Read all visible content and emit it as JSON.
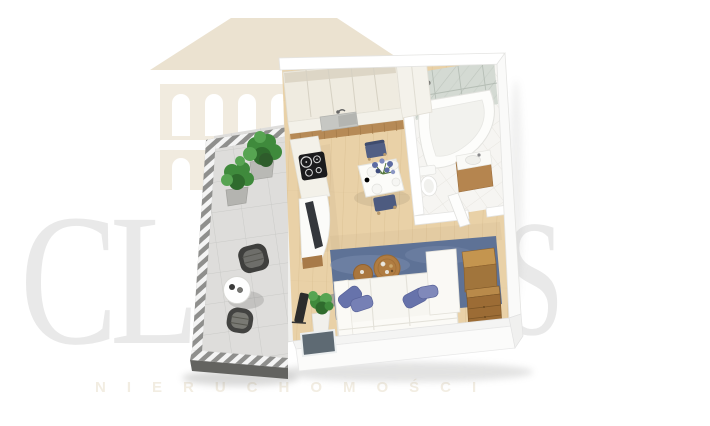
{
  "watermark": {
    "brand_letters_left": "CL",
    "brand_letter_right": "S",
    "tagline": "NIERUCHOMOŚCI"
  },
  "palette": {
    "wm_letter": "#e9e9e9",
    "wm_logo": "#f1ebdf",
    "wm_logo_roof": "#ebe2d0",
    "wm_tagline": "#f2ede2",
    "wall": "#ffffff",
    "wall_edge": "#e4e4e2",
    "wood_floor": "#e9d1a7",
    "wood_line": "#d9bd90",
    "balcony_tile": "#dedddb",
    "railing": "#8f8f8d",
    "railing_dark": "#636360",
    "cabinet": "#efebe0",
    "counter": "#f3f1e9",
    "marble": "#d4dad3",
    "island_wood": "#b68a56",
    "cooktop": "#1b1b1d",
    "steel": "#c6c7c3",
    "rug": "#5e7296",
    "rug_light": "#7e90b2",
    "pillow": "#6773ab",
    "sofa": "#f7f6f1",
    "coffee_wood": "#b07c41",
    "chest_top": "#c4954f",
    "chest_front": "#9c6c35",
    "plant": "#3f8a3c",
    "plant_dark": "#2f6b2d",
    "chair_blue": "#515f84",
    "dark_item": "#34373c"
  },
  "scene": {
    "type": "3d-floorplan-top-view",
    "rooms": [
      "balcony",
      "kitchen",
      "dining-area",
      "bathroom",
      "living-area",
      "entry"
    ],
    "furnishings": {
      "balcony": [
        "potted-plant",
        "potted-plant",
        "bistro-table",
        "rattan-chair",
        "rattan-chair"
      ],
      "kitchen": [
        "upper-cabinets",
        "tall-cabinet",
        "sink",
        "induction-cooktop",
        "counter",
        "tv"
      ],
      "dining-area": [
        "dining-table",
        "dining-chair",
        "dining-chair",
        "flower-bouquet",
        "tableware"
      ],
      "bathroom": [
        "corner-bathtub",
        "shower-set",
        "toilet",
        "vanity-sink",
        "open-door",
        "marble-wall"
      ],
      "living-area": [
        "corner-sofa",
        "blue-pillows",
        "round-coffee-table",
        "round-coffee-table",
        "area-rug",
        "wooden-chest",
        "potted-plant",
        "floor-lamp"
      ]
    }
  }
}
